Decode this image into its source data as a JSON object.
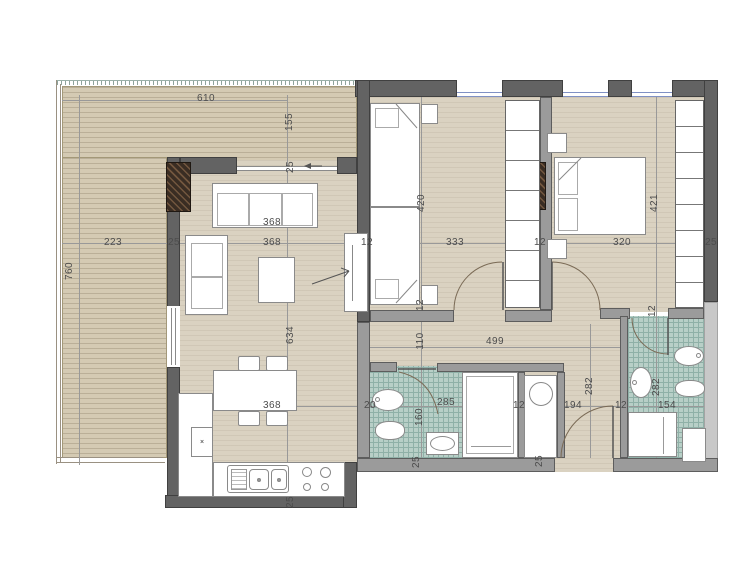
{
  "title": "apartment-floor-plan",
  "colors": {
    "deck": "#d4cab3",
    "floor": "#dad2c1",
    "tile": "#b8cfc7",
    "tile_grid": "#8fb0a7",
    "wall_dark": "#636363",
    "wall_mid": "#9b9b9b",
    "wall_light": "#c8c8c8",
    "glass": "#8091c4",
    "dim_text": "#4c4c4c",
    "column": "#3a2d23",
    "arc": "#7a6a55"
  },
  "kitchen": {
    "knob": "×"
  },
  "dimensions": [
    {
      "text": "610",
      "x": 206,
      "y": 99,
      "vertical": false
    },
    {
      "text": "155",
      "x": 290,
      "y": 122,
      "vertical": true
    },
    {
      "text": "25",
      "x": 291,
      "y": 167,
      "vertical": true
    },
    {
      "text": "223",
      "x": 113,
      "y": 243,
      "vertical": false
    },
    {
      "text": "25",
      "x": 174,
      "y": 243,
      "vertical": false
    },
    {
      "text": "368",
      "x": 272,
      "y": 223,
      "vertical": false
    },
    {
      "text": "368",
      "x": 272,
      "y": 243,
      "vertical": false
    },
    {
      "text": "12",
      "x": 367,
      "y": 243,
      "vertical": false
    },
    {
      "text": "333",
      "x": 455,
      "y": 243,
      "vertical": false
    },
    {
      "text": "12",
      "x": 540,
      "y": 243,
      "vertical": false
    },
    {
      "text": "320",
      "x": 622,
      "y": 243,
      "vertical": false
    },
    {
      "text": "25",
      "x": 711,
      "y": 243,
      "vertical": false
    },
    {
      "text": "760",
      "x": 70,
      "y": 271,
      "vertical": true
    },
    {
      "text": "420",
      "x": 422,
      "y": 203,
      "vertical": true
    },
    {
      "text": "421",
      "x": 655,
      "y": 203,
      "vertical": true
    },
    {
      "text": "634",
      "x": 291,
      "y": 335,
      "vertical": true
    },
    {
      "text": "110",
      "x": 421,
      "y": 341,
      "vertical": true
    },
    {
      "text": "12",
      "x": 421,
      "y": 305,
      "vertical": true
    },
    {
      "text": "499",
      "x": 495,
      "y": 342,
      "vertical": false
    },
    {
      "text": "282",
      "x": 590,
      "y": 386,
      "vertical": true
    },
    {
      "text": "282",
      "x": 657,
      "y": 387,
      "vertical": true
    },
    {
      "text": "12",
      "x": 653,
      "y": 311,
      "vertical": true
    },
    {
      "text": "368",
      "x": 272,
      "y": 406,
      "vertical": false
    },
    {
      "text": "20",
      "x": 370,
      "y": 406,
      "vertical": false
    },
    {
      "text": "285",
      "x": 446,
      "y": 403,
      "vertical": false
    },
    {
      "text": "12",
      "x": 519,
      "y": 406,
      "vertical": false
    },
    {
      "text": "194",
      "x": 573,
      "y": 406,
      "vertical": false
    },
    {
      "text": "12",
      "x": 621,
      "y": 406,
      "vertical": false
    },
    {
      "text": "154",
      "x": 667,
      "y": 406,
      "vertical": false
    },
    {
      "text": "160",
      "x": 420,
      "y": 417,
      "vertical": true
    },
    {
      "text": "25",
      "x": 417,
      "y": 462,
      "vertical": true
    },
    {
      "text": "25",
      "x": 540,
      "y": 461,
      "vertical": true
    },
    {
      "text": "25",
      "x": 291,
      "y": 502,
      "vertical": true
    }
  ]
}
